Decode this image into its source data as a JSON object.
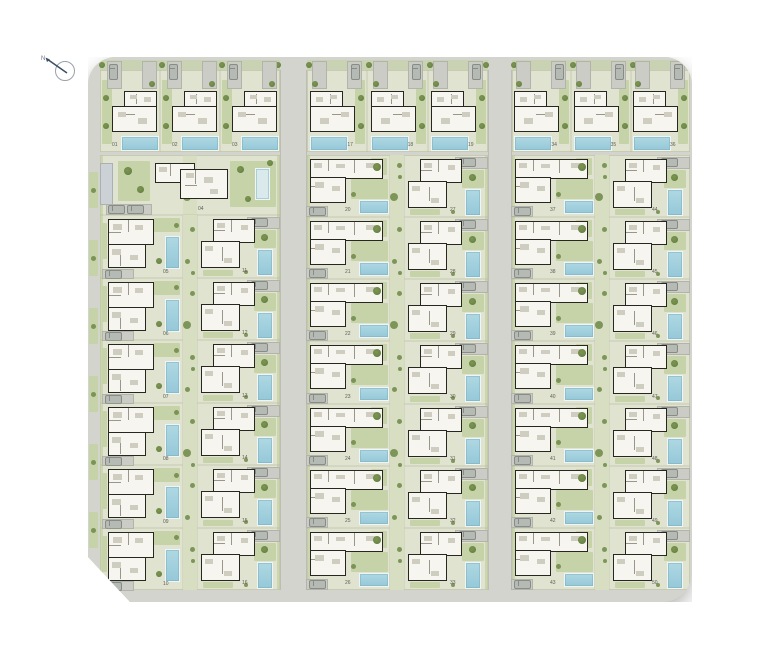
{
  "compass": {
    "label": "N"
  },
  "colors": {
    "road": "#d3d4cd",
    "road_edge": "#bfc1b8",
    "plot": "#e0e3d0",
    "plot_line": "#c9cfb6",
    "grass": "#c6d2a8",
    "grass_dark": "#b7c896",
    "divider": "#d7dec2",
    "tree": "#6d8847",
    "tree_dark": "#4e6933",
    "pool": "#aed8e3",
    "pool_deep": "#96c8d8",
    "pool_border": "#eef5f6",
    "pool_pale": "#d9e9ec",
    "wall": "#27261f",
    "house": "#f6f5ef",
    "inner_wall": "#9a968a",
    "furniture": "#cfccc0",
    "driveway": "#cbccc5",
    "driveway_line": "#b2b3ab",
    "car": "#b6bab5",
    "car_line": "#878c87",
    "shed": "#ccd1d5",
    "label": "#5d5d55",
    "compass_ring": "#99a1aa",
    "compass_needle": "#3c4f63"
  },
  "site_plan": {
    "top_row_groups": [
      {
        "id": "group-left",
        "plots": [
          "01",
          "02",
          "03"
        ]
      },
      {
        "id": "group-middle",
        "plots": [
          "17",
          "18",
          "19"
        ]
      },
      {
        "id": "group-right",
        "plots": [
          "34",
          "35",
          "36"
        ]
      }
    ],
    "left_block": {
      "special_plot": "04",
      "column_a": [
        "05",
        "06",
        "07",
        "08",
        "09",
        "10"
      ],
      "column_b": [
        "11",
        "12",
        "13",
        "14",
        "15",
        "16"
      ]
    },
    "middle_block": {
      "column_a": [
        "20",
        "21",
        "22",
        "23",
        "24",
        "25",
        "26"
      ],
      "column_b": [
        "27",
        "28",
        "29",
        "30",
        "31",
        "32",
        "33"
      ]
    },
    "right_block": {
      "column_a": [
        "37",
        "38",
        "39",
        "40",
        "41",
        "42",
        "43"
      ],
      "column_b": [
        "44",
        "45",
        "46",
        "47",
        "48",
        "49",
        "50"
      ]
    }
  }
}
